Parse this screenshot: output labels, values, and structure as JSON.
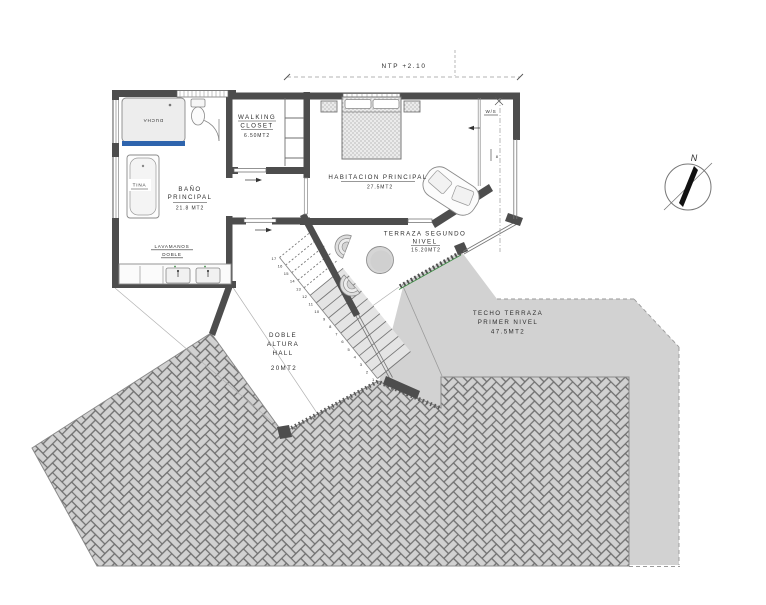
{
  "dimension": {
    "label": "NTP +2.10"
  },
  "rooms": {
    "bathroom": {
      "l1": "BAÑO",
      "l2": "PRINCIPAL",
      "area": "21.8 MT2"
    },
    "closet": {
      "l1": "WALKING",
      "l2": "CLOSET",
      "area": "6.50MT2"
    },
    "bedroom": {
      "name": "HABITACION PRINCIPAL",
      "area": "27.5MT2"
    },
    "terrace": {
      "l1": "TERRAZA SEGUNDO",
      "l2": "NIVEL",
      "area": "15.20MT2"
    },
    "hall": {
      "l1": "DOBLE",
      "l2": "ALTURA",
      "l3": "HALL",
      "area": "20MT2"
    },
    "roof": {
      "l1": "TECHO TERRAZA",
      "l2": "PRIMER NIVEL",
      "area": "47.5MT2"
    }
  },
  "fixtures": {
    "shower": "DUCHA",
    "tub": "TINA",
    "sink1": "LAVAMANOS",
    "sink2": "DOBLE",
    "window_seat": "W/S",
    "door_tag": "8"
  },
  "compass": {
    "north": "N"
  },
  "stairs": {
    "count": 17
  },
  "colors": {
    "wall": "#4d4d4d",
    "accent_blue": "#2e64ad",
    "accent_green": "#3f8f46",
    "roof_gray": "#d2d2d2",
    "text": "#2e2e2e"
  }
}
